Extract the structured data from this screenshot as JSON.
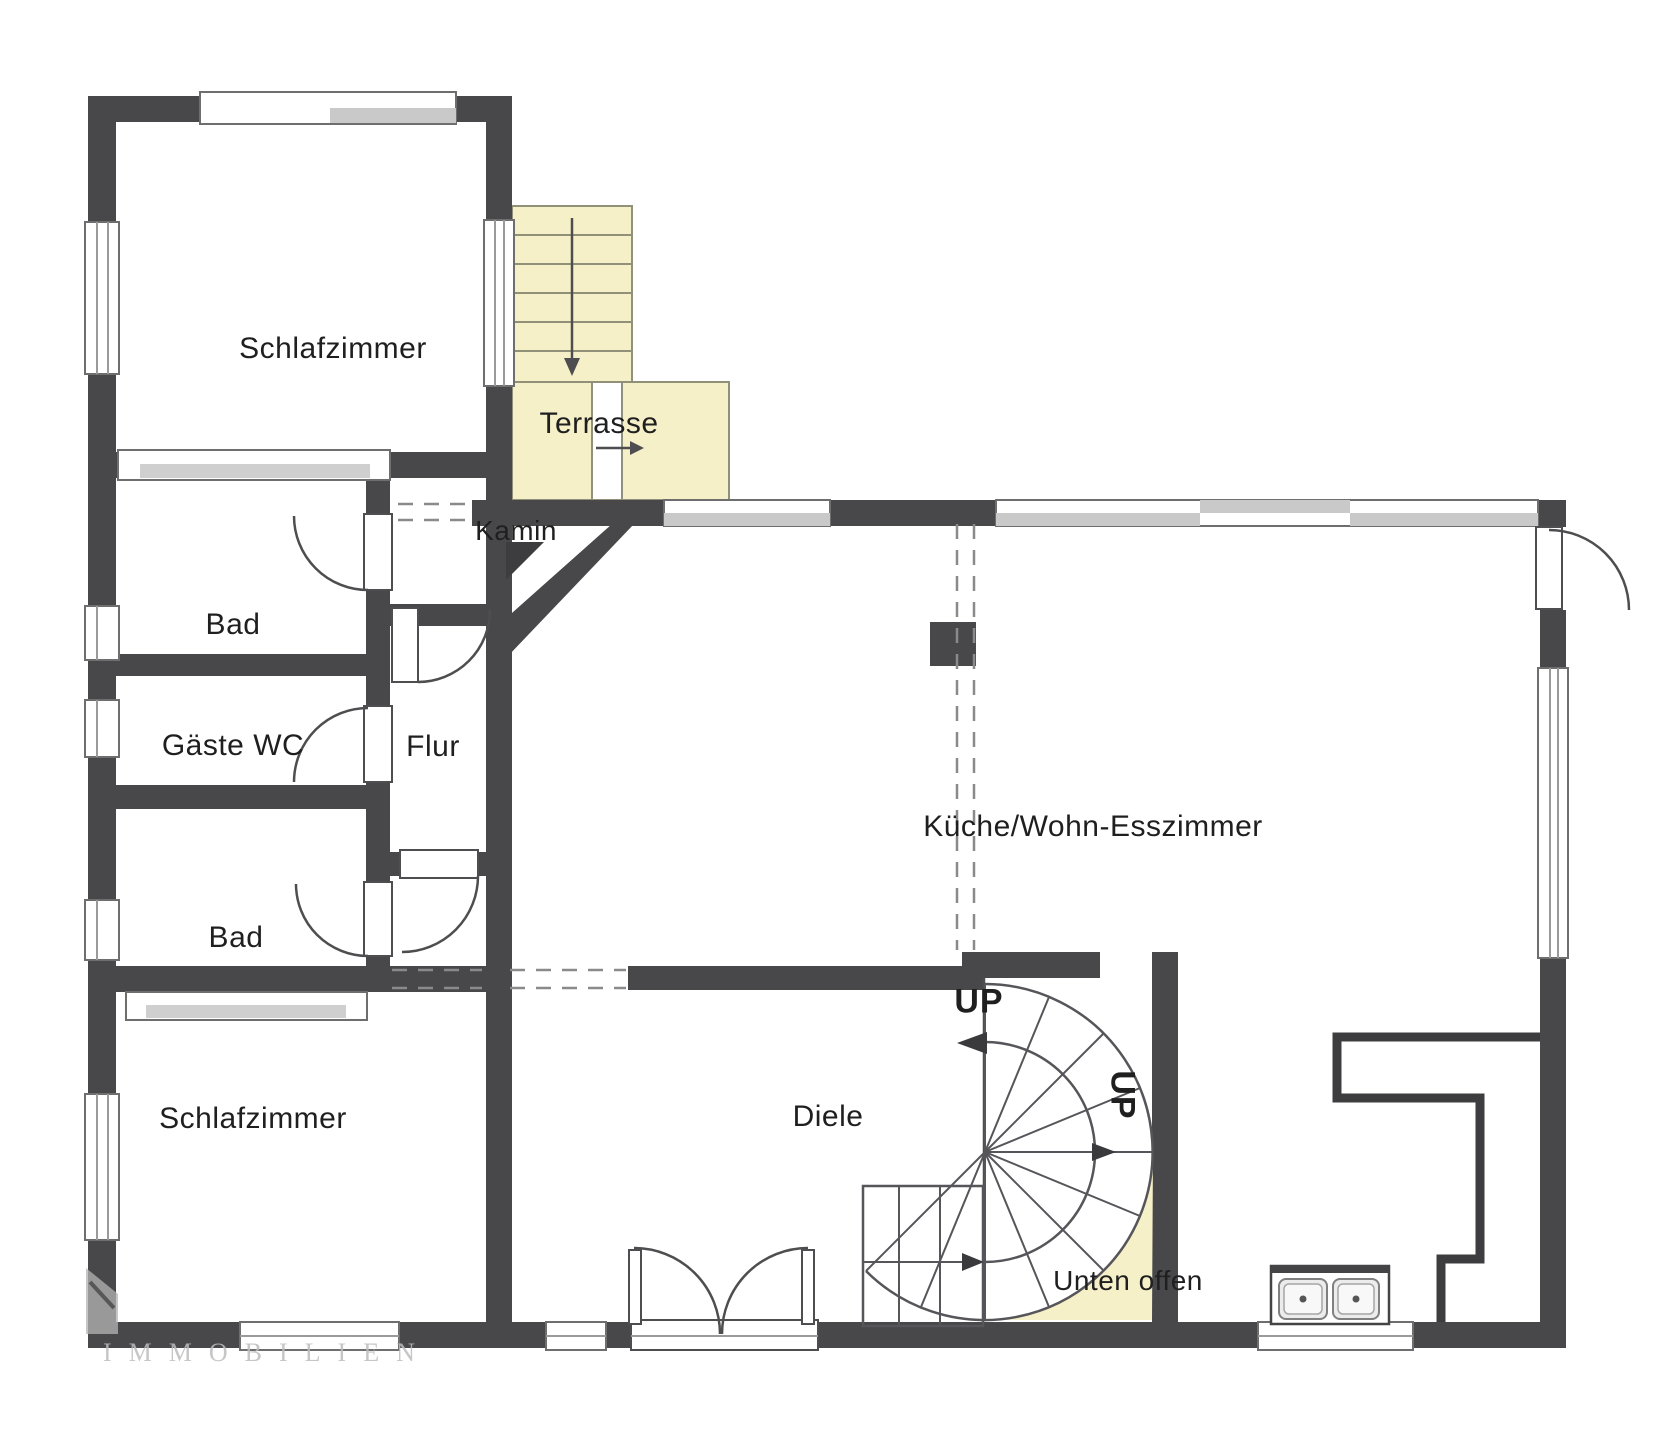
{
  "labels": {
    "schlafzimmer_top": "Schlafzimmer",
    "terrasse": "Terrasse",
    "kamin": "Kamin",
    "bad_top": "Bad",
    "gaeste_wc": "Gäste WC",
    "flur": "Flur",
    "bad_bottom": "Bad",
    "schlafzimmer_bottom": "Schlafzimmer",
    "kueche": "Küche/Wohn-Esszimmer",
    "diele": "Diele",
    "up_top": "UP",
    "up_side": "UP",
    "unten_offen": "Unten offen",
    "watermark": "IMMOBILIEN"
  },
  "colors": {
    "wall": "#48484a",
    "window_frame": "#6e6e6e",
    "window_glass_gray": "#c9c9c9",
    "terrace_fill": "#f6f0c8",
    "terrace_border": "#91917a",
    "thin_line": "#4e4e50",
    "watermark_gray": "#bdbdbd"
  }
}
